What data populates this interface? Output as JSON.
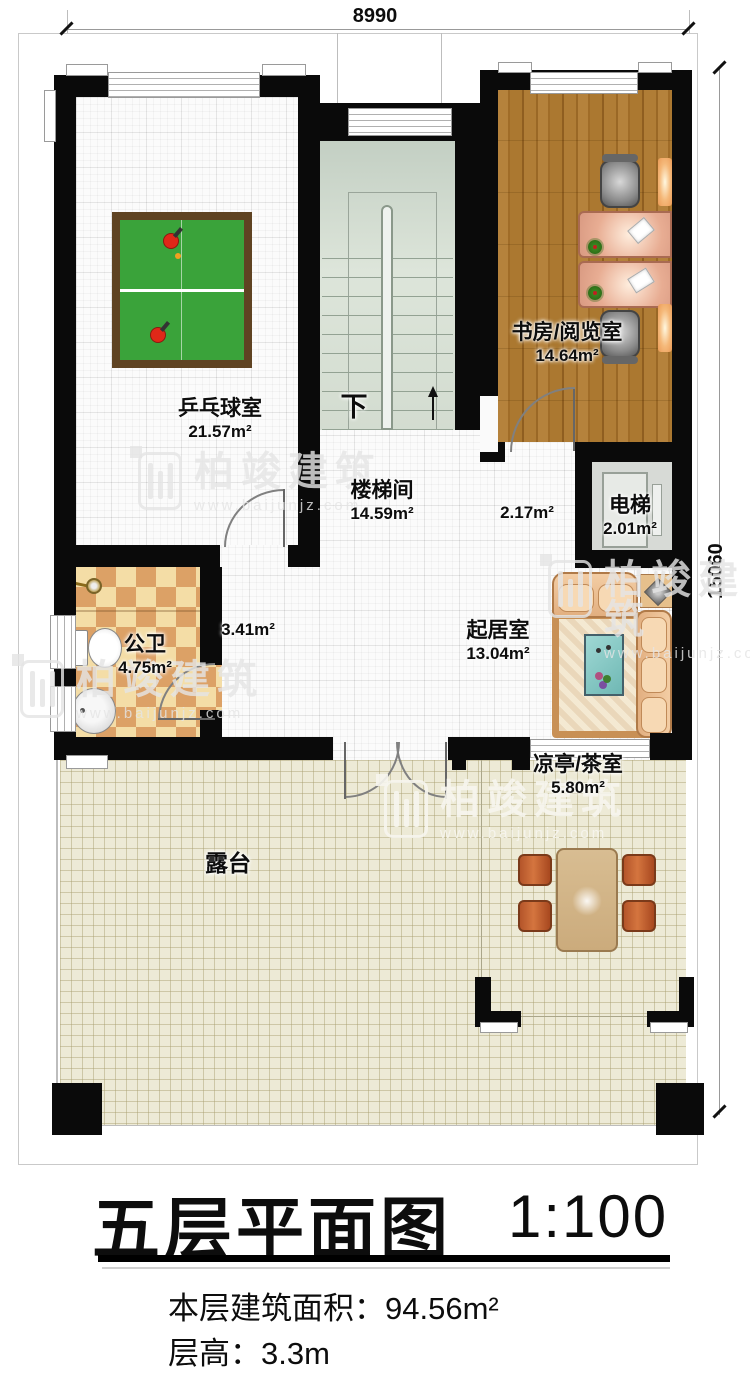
{
  "plan": {
    "dimensions": {
      "width_label": "8990",
      "height_label": "15060"
    },
    "rooms": {
      "pingpong": {
        "name": "乒乓球室",
        "area": "21.57m²"
      },
      "study": {
        "name": "书房/阅览室",
        "area": "14.64m²"
      },
      "stairwell": {
        "name": "楼梯间",
        "area": "14.59m²"
      },
      "hall": {
        "area": "2.17m²"
      },
      "elevator": {
        "name": "电梯",
        "area": "2.01m²"
      },
      "bathroom": {
        "name": "公卫",
        "area": "4.75m²"
      },
      "corridor": {
        "area": "3.41m²"
      },
      "living": {
        "name": "起居室",
        "area": "13.04m²"
      },
      "pavilion": {
        "name": "凉亭/茶室",
        "area": "5.80m²"
      },
      "terrace": {
        "name": "露台"
      }
    },
    "stair_direction": "下"
  },
  "titleblock": {
    "title": "五层平面图",
    "scale": "1:100",
    "area_label": "本层建筑面积：",
    "area_value": "94.56m²",
    "height_label": "层高：",
    "height_value": "3.3m"
  },
  "watermark": {
    "brand": "柏竣建筑",
    "url": "www.baijunjz.com"
  },
  "colors": {
    "wall": "#0a0a0a",
    "wood_floor": "#a9762f",
    "terrace_floor": "#edead6",
    "stair_floor": "#d9e1d7",
    "pingpong_table": "#3aa33a",
    "bathroom_tile_light": "#f4dda6",
    "bathroom_tile_dark": "#dca166",
    "sofa": "#eec49b",
    "desk": "#dfa28d"
  }
}
